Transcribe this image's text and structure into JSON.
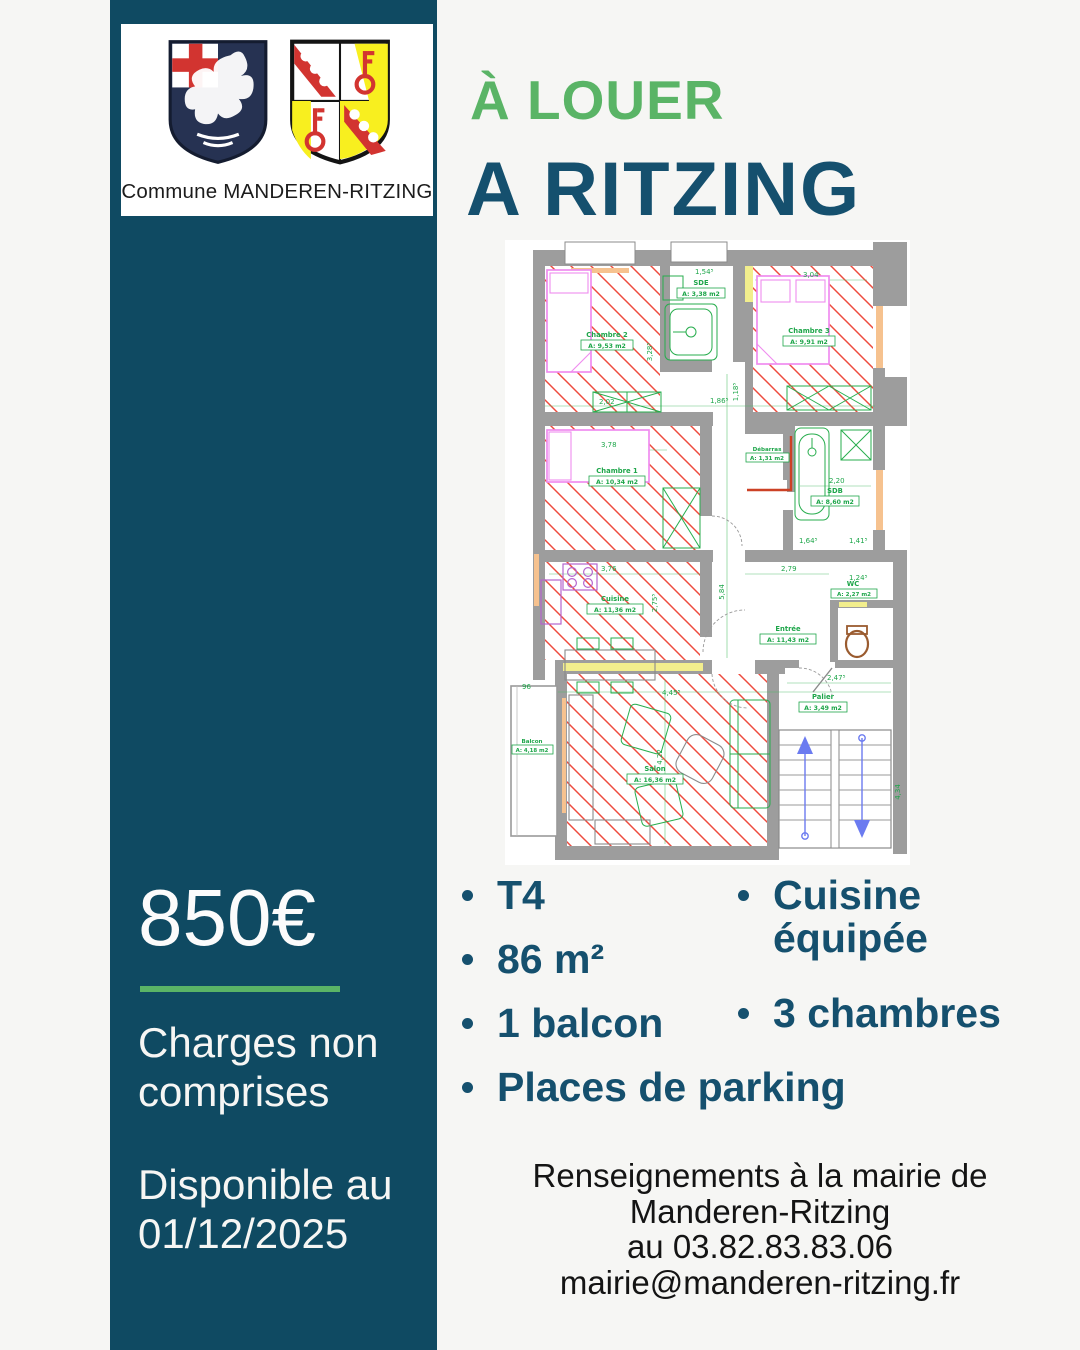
{
  "colors": {
    "panel_teal": "#0f4a62",
    "accent_green": "#5ab466",
    "heading_teal": "#15506e",
    "hatch_red": "#ee4b3e"
  },
  "brand": {
    "caption": "Commune MANDEREN-RITZING"
  },
  "header": {
    "badge": "À LOUER",
    "title": "A RITZING"
  },
  "sidebar": {
    "price": "850€",
    "note": "Charges non comprises",
    "availability": "Disponible au 01/12/2025"
  },
  "features": {
    "left": [
      "T4",
      "86 m²",
      "1 balcon",
      "Places de parking"
    ],
    "right": [
      "Cuisine équipée",
      "3 chambres"
    ]
  },
  "footer": {
    "lines": [
      "Renseignements à la mairie de",
      "Manderen-Ritzing",
      "au 03.82.83.83.06",
      "mairie@manderen-ritzing.fr"
    ]
  },
  "floorplan": {
    "rooms": [
      {
        "name": "Chambre 2",
        "area": "A: 9,53 m2"
      },
      {
        "name": "SDE",
        "area": "A: 3,38 m2"
      },
      {
        "name": "Chambre 3",
        "area": "A: 9,91 m2"
      },
      {
        "name": "Chambre 1",
        "area": "A: 10,34 m2"
      },
      {
        "name": "Débarras",
        "area": "A: 1,31 m2"
      },
      {
        "name": "SDB",
        "area": "A: 8,60 m2"
      },
      {
        "name": "Cuisine",
        "area": "A: 11,36 m2"
      },
      {
        "name": "Entrée",
        "area": "A: 11,43 m2"
      },
      {
        "name": "WC",
        "area": "A: 2,27 m2"
      },
      {
        "name": "Salon",
        "area": "A: 16,36 m2"
      },
      {
        "name": "Balcon",
        "area": "A: 4,18 m2"
      },
      {
        "name": "Palier",
        "area": "A: 3,49 m2"
      }
    ],
    "dims": [
      "1,54⁵",
      "3,04",
      "3,28⁵",
      "2,02",
      "1,86⁵",
      "1,18⁵",
      "3,78",
      "2,75⁵",
      "3,76",
      "2,79",
      "5,84",
      "2,20",
      "1,64⁵",
      "1,41⁵",
      "1,24⁵",
      "2,47⁵",
      "4,45⁵",
      "96",
      "4,22",
      "4,34"
    ]
  }
}
